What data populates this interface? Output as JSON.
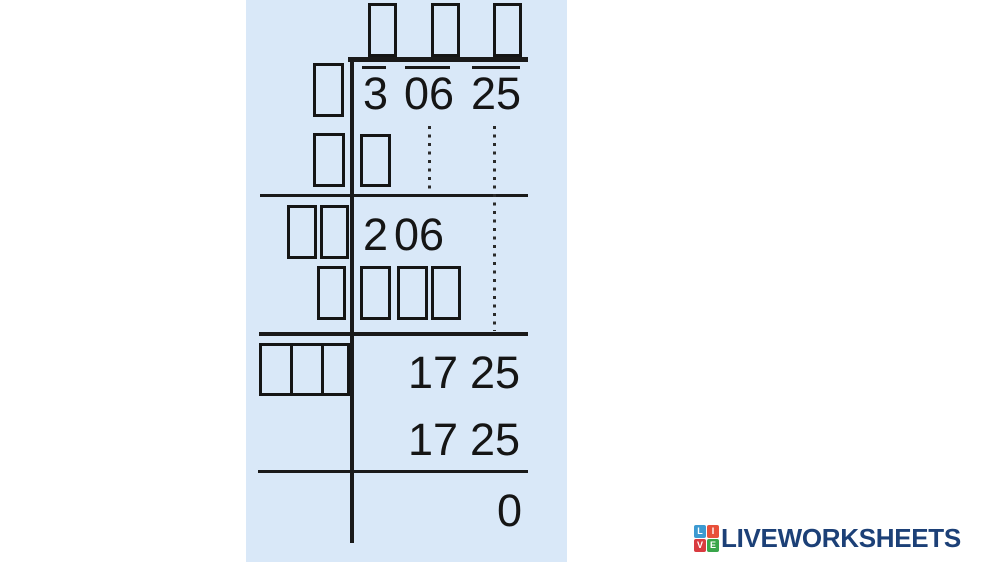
{
  "colors": {
    "panel_bg": "#d9e8f8",
    "ink": "#1a1a1a",
    "logo_text": "#1c4077",
    "tile_l": "#3d9ad1",
    "tile_i": "#e8503a",
    "tile_v": "#d93b40",
    "tile_e": "#39a54a"
  },
  "problem": {
    "radicand_groups": [
      "3",
      "06",
      "25"
    ],
    "work_row1_groups": [
      "2",
      "06"
    ],
    "work_row2_groups": [
      "17",
      "25"
    ],
    "work_row3_groups": [
      "17",
      "25"
    ],
    "remainder": "0"
  },
  "logo": {
    "text": "LIVEWORKSHEETS",
    "tiles": [
      {
        "letter": "L",
        "color": "#3d9ad1"
      },
      {
        "letter": "I",
        "color": "#e8503a"
      },
      {
        "letter": "V",
        "color": "#d93b40"
      },
      {
        "letter": "E",
        "color": "#39a54a"
      }
    ]
  }
}
